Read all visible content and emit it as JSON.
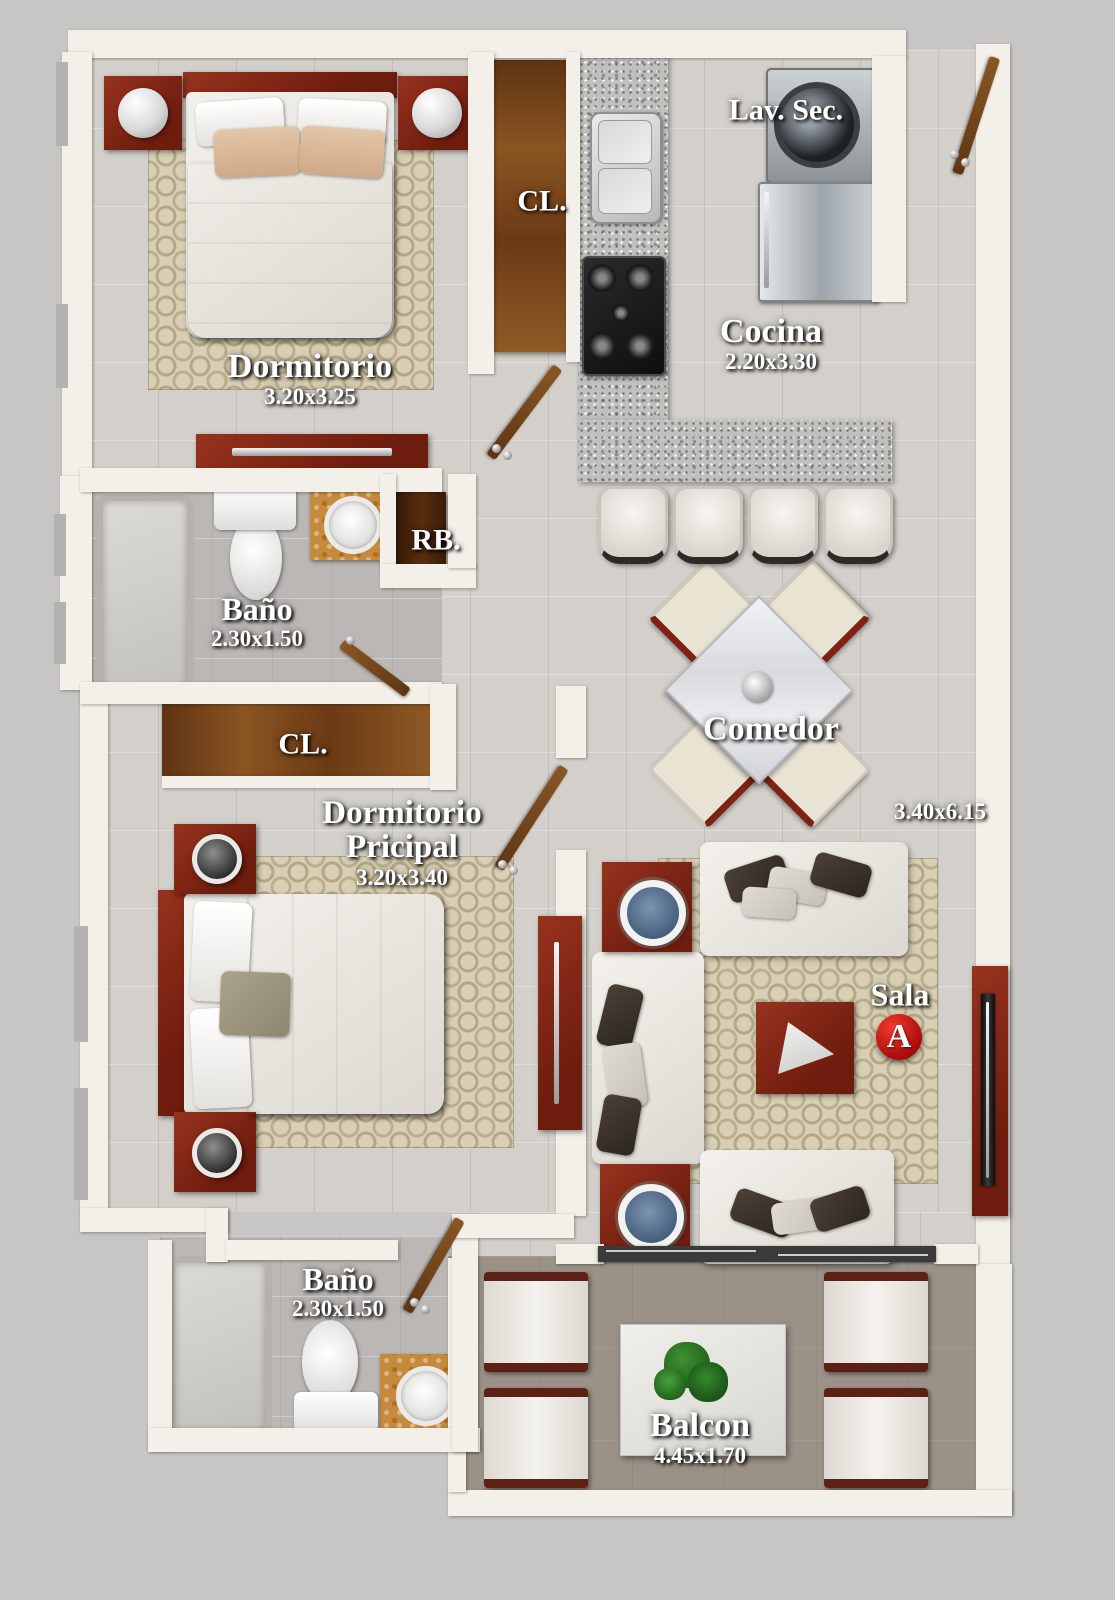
{
  "plan": {
    "type": "apartment-floor-plan",
    "unit_badge": "A",
    "colors": {
      "background": "#c7c6c4",
      "walls": "#f2f0e8",
      "wood_closet": "#7c4a1d",
      "furniture_red": "#7e2213",
      "rug_beige": "#d8cfb5",
      "balcony_floor": "#9b9287",
      "badge_red": "#b50c0c",
      "label_text": "#ffffff"
    },
    "rooms": {
      "dormitorio": {
        "name": "Dormitorio",
        "dims": "3.20x3.25"
      },
      "closet_top": {
        "name": "CL."
      },
      "lavanderia": {
        "name": "Lav. Sec."
      },
      "cocina": {
        "name": "Cocina",
        "dims": "2.20x3.30"
      },
      "ropero": {
        "name": "RB."
      },
      "bano_superior": {
        "name": "Baño",
        "dims": "2.30x1.50"
      },
      "closet_principal": {
        "name": "CL."
      },
      "dormitorio_principal": {
        "name_line1": "Dormitorio",
        "name_line2": "Pricipal",
        "dims": "3.20x3.40"
      },
      "comedor": {
        "name": "Comedor"
      },
      "sala": {
        "name": "Sala",
        "dims": "3.40x6.15"
      },
      "bano_inferior": {
        "name": "Baño",
        "dims": "2.30x1.50"
      },
      "balcon": {
        "name": "Balcon",
        "dims": "4.45x1.70"
      }
    }
  }
}
